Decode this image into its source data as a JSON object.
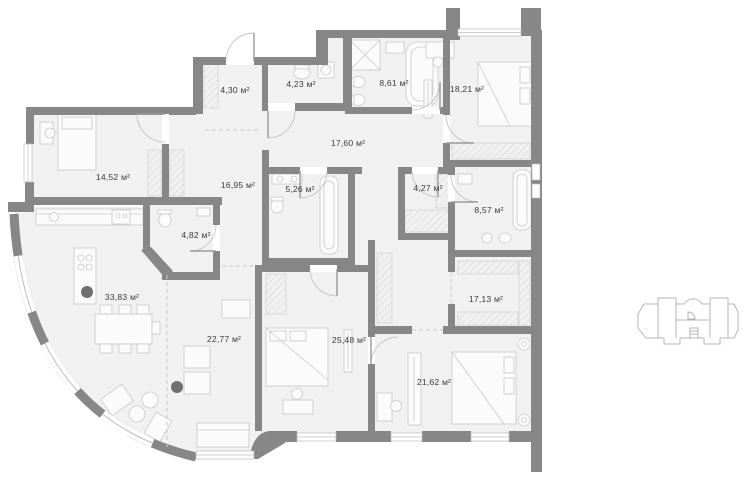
{
  "floor_plan": {
    "unit": "м²",
    "rooms": [
      {
        "id": "entry-hall",
        "area_label": "4,30 м²"
      },
      {
        "id": "guest-bathroom",
        "area_label": "4,23 м²"
      },
      {
        "id": "master-bathroom",
        "area_label": "8,61 м²"
      },
      {
        "id": "bedroom-top-right",
        "area_label": "18,21 м²"
      },
      {
        "id": "room-left",
        "area_label": "14,52 м²"
      },
      {
        "id": "corridor",
        "area_label": "17,60 м²"
      },
      {
        "id": "hallway",
        "area_label": "16,95 м²"
      },
      {
        "id": "bathroom-middle",
        "area_label": "5,26 м²"
      },
      {
        "id": "closet",
        "area_label": "4,27 м²"
      },
      {
        "id": "bathroom-right",
        "area_label": "8,57 м²"
      },
      {
        "id": "wc",
        "area_label": "4,82 м²"
      },
      {
        "id": "kitchen-dining",
        "area_label": "33,83 м²"
      },
      {
        "id": "wardrobe-room",
        "area_label": "17,13 м²"
      },
      {
        "id": "living-room",
        "area_label": "22,77 м²"
      },
      {
        "id": "bedroom-middle",
        "area_label": "25,48 м²"
      },
      {
        "id": "bedroom-bottom-right",
        "area_label": "21,62 м²"
      }
    ],
    "colors": {
      "wall": "#878787",
      "floor": "#f1f1f1",
      "furniture_line": "#c9c9c9",
      "label_text": "#3c3c3c",
      "window_line": "#bdbdbd",
      "mini_plan_line": "#b5b5b5",
      "column": "#6f6f6f"
    }
  },
  "mini_plan": {
    "description": "building-footprint-outline"
  }
}
